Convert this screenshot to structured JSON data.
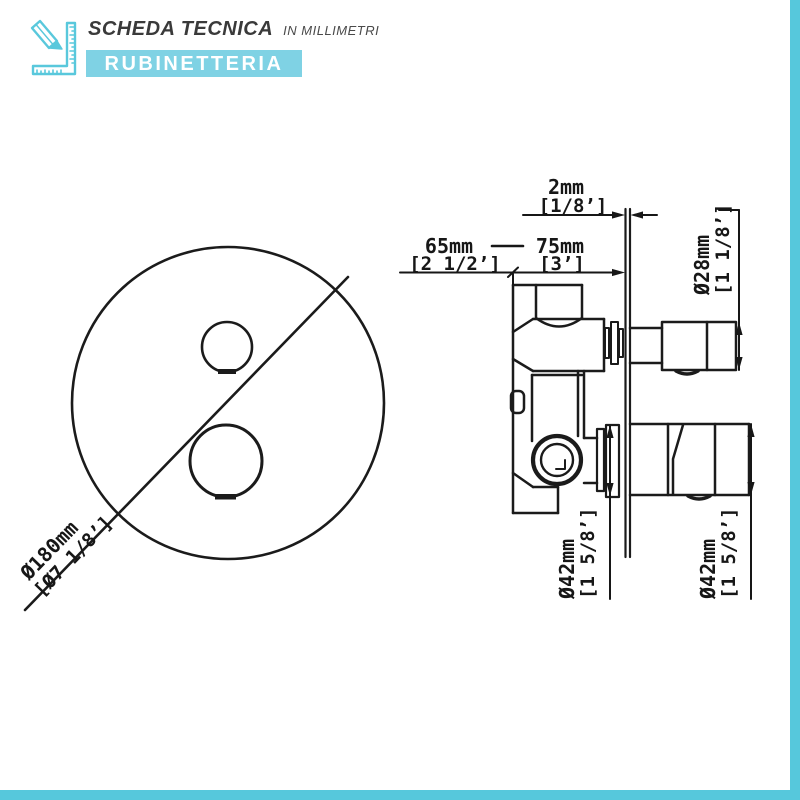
{
  "header": {
    "title": "SCHEDA TECNICA",
    "subtitle": "IN MILLIMETRI",
    "banner": "RUBINETTERIA"
  },
  "accent": {
    "edge_color": "#56c8dc",
    "banner_color": "#7fd2e4",
    "line_color": "#1b1b1b"
  },
  "front_view": {
    "diameter_mm": "Ø180mm",
    "diameter_in": "[Ø7 1/8’]"
  },
  "side_view": {
    "plate_mm": "2mm",
    "plate_in": "[1/8’]",
    "depth_min_mm": "65mm",
    "depth_min_in": "[2 1/2’]",
    "depth_max_mm": "75mm",
    "depth_max_in": "[3’]",
    "knob_top_mm": "Ø28mm",
    "knob_top_in": "[1 1/8’]",
    "flange_mm": "Ø42mm",
    "flange_in": "[1 5/8’]",
    "knob_bottom_mm": "Ø42mm",
    "knob_bottom_in": "[1 5/8’]"
  }
}
